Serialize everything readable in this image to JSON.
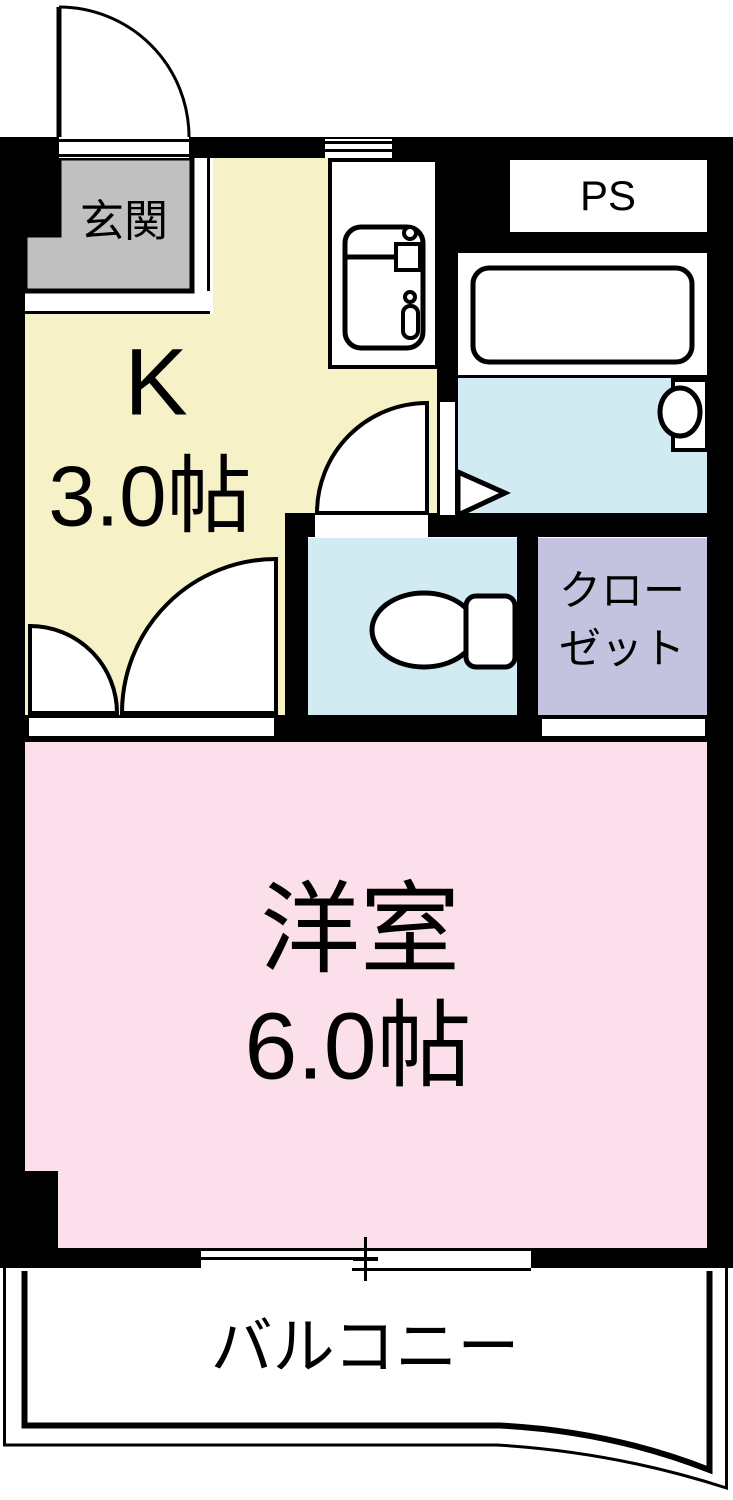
{
  "plan_title": "1K apartment floor plan",
  "rooms": {
    "genkan": {
      "label": "玄関"
    },
    "kitchen": {
      "type_label": "K",
      "size_label": "3.0帖"
    },
    "pipe_space": {
      "label": "PS"
    },
    "closet": {
      "label_line1": "クロー",
      "label_line2": "ゼット"
    },
    "western_room": {
      "label": "洋室",
      "size_label": "6.0帖"
    },
    "balcony": {
      "label": "バルコニー"
    }
  },
  "colors": {
    "wall": "#000000",
    "genkan_floor": "#c0c0c0",
    "kitchen_floor": "#f6f1c6",
    "western_room_floor": "#fbe0eb",
    "wet_area_floor": "#d2ebf3",
    "closet_floor": "#c3c3df",
    "fixture_fill": "#ffffff"
  }
}
